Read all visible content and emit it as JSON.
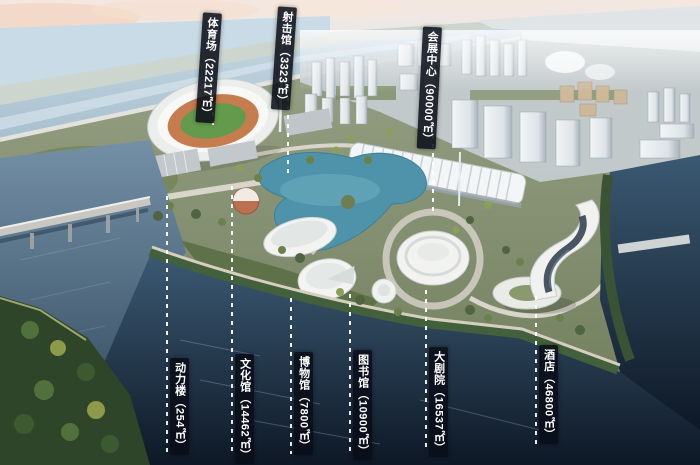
{
  "annotations": {
    "top": [
      {
        "name": "体育场",
        "area": "（22217㎡）"
      },
      {
        "name": "射击馆",
        "area": "（3323㎡）"
      },
      {
        "name": "会展中心",
        "area": "（90000㎡）"
      }
    ],
    "bottom": [
      {
        "name": "动力楼",
        "area": "（254㎡）"
      },
      {
        "name": "文化馆",
        "area": "（14462㎡）"
      },
      {
        "name": "博物馆",
        "area": "（7800㎡）"
      },
      {
        "name": "图书馆",
        "area": "（10900㎡）"
      },
      {
        "name": "大剧院",
        "area": "（16537㎡）"
      },
      {
        "name": "酒店",
        "area": "（46800㎡）"
      }
    ]
  },
  "colors": {
    "label_background": "#0a0f1a",
    "label_text": "#ffffff",
    "leader_line": "#ffffff",
    "river": "#b3c8d6",
    "lake": "#4f93aa",
    "dark_water": "#16222f",
    "foliage": "#5c6f45",
    "sky_haze": "#f2e3dc"
  }
}
